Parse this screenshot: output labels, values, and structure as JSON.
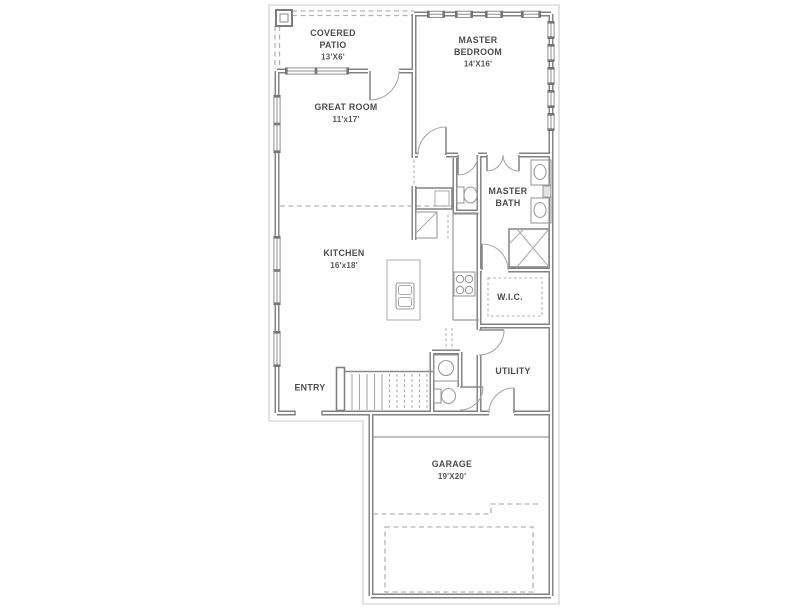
{
  "colors": {
    "background": "#ffffff",
    "wall_gray": "#818181",
    "thin_line_gray": "#9a9a9a",
    "dashed_line_gray": "#b3b3b3",
    "label_text_gray": "#4c4c4c"
  },
  "rooms": {
    "covered_patio": {
      "name_line1": "COVERED",
      "name_line2": "PATIO",
      "dims": "13'X6'"
    },
    "master_bedroom": {
      "name_line1": "MASTER",
      "name_line2": "BEDROOM",
      "dims": "14'X16'"
    },
    "great_room": {
      "name_line1": "GREAT ROOM",
      "dims": "11'x17'"
    },
    "kitchen": {
      "name_line1": "KITCHEN",
      "dims": "16'x18'"
    },
    "master_bath": {
      "name_line1": "MASTER",
      "name_line2": "BATH"
    },
    "walk_in_closet": {
      "name_line1": "W.I.C."
    },
    "utility": {
      "name_line1": "UTILITY"
    },
    "entry": {
      "name_line1": "ENTRY"
    },
    "garage": {
      "name_line1": "GARAGE",
      "dims": "19'X20'"
    }
  },
  "fixtures": [
    "patio-post",
    "stairs",
    "kitchen-island-sink",
    "range-cooktop",
    "pantry-cabinet",
    "linen-cabinet",
    "wc-toilet",
    "double-vanity-sinks",
    "walk-in-shower",
    "wic-shelving",
    "powder-vanity-sink",
    "powder-toilet",
    "garage-slab-dashed-outline"
  ]
}
